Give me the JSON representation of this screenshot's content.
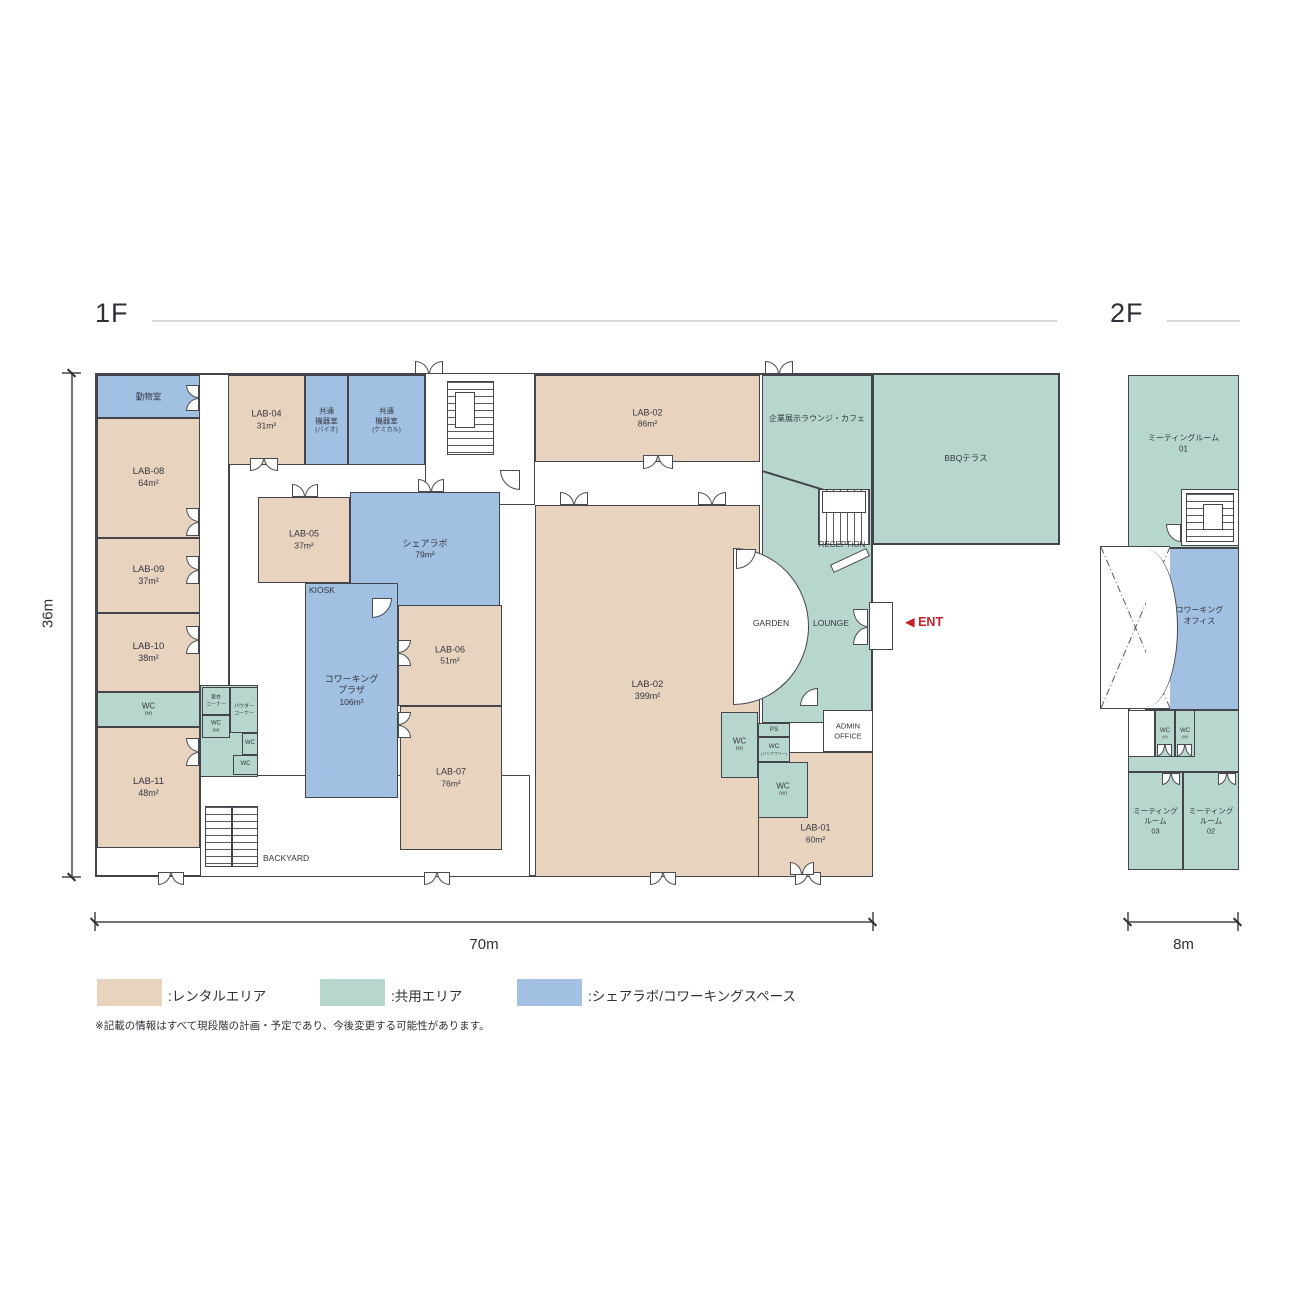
{
  "titles": {
    "floor1": "1F",
    "floor2": "2F"
  },
  "dimensions": {
    "height_1f": "36m",
    "width_1f": "70m",
    "width_2f": "8m"
  },
  "colors": {
    "wall": "#44454c",
    "rental": "#e8d4be",
    "shared": "#b7d7ce",
    "cowork": "#a2c0e1",
    "accent_red": "#c5202e",
    "header_line": "#d9d9d9"
  },
  "legend": {
    "items": [
      {
        "key": "rental",
        "label": ":レンタルエリア",
        "color": "#e8d4be"
      },
      {
        "key": "shared",
        "label": ":共用エリア",
        "color": "#b7d7ce"
      },
      {
        "key": "cowork",
        "label": ":シェアラボ/コワーキングスペース",
        "color": "#a2c0e1"
      }
    ],
    "note": "※記載の情報はすべて現段階の計画・予定であり、今後変更する可能性があります。"
  },
  "plan": {
    "boxes": [
      {
        "n": "building-1f",
        "cls": "shell",
        "x": 95,
        "y": 373,
        "w": 778,
        "h": 504
      },
      {
        "n": "bbq-terrace",
        "cls": "shared b2",
        "x": 872,
        "y": 373,
        "w": 188,
        "h": 172
      },
      {
        "n": "building-2f",
        "cls": "shell",
        "x": 1128,
        "y": 375,
        "w": 111,
        "h": 495
      },
      {
        "n": "stair-lobby",
        "cls": "wbox",
        "x": 425,
        "y": 373,
        "w": 110,
        "h": 132
      },
      {
        "n": "backyard-area",
        "cls": "wbox",
        "x": 200,
        "y": 775,
        "w": 330,
        "h": 102
      },
      {
        "n": "corridor-wall",
        "cls": "wall",
        "x": 228,
        "y": 463,
        "w": 2,
        "h": 224
      },
      {
        "n": "animal-room",
        "cls": "cowork",
        "x": 97,
        "y": 375,
        "w": 103,
        "h": 43,
        "lines": [
          [
            "動物室",
            1
          ]
        ],
        "fs": 8.5
      },
      {
        "n": "lab-08",
        "cls": "rental",
        "x": 97,
        "y": 418,
        "w": 103,
        "h": 120,
        "lines": [
          [
            "LAB-08",
            1
          ],
          [
            "64m²",
            0.95
          ]
        ],
        "fs": 9.5
      },
      {
        "n": "lab-09",
        "cls": "rental",
        "x": 97,
        "y": 538,
        "w": 103,
        "h": 75,
        "lines": [
          [
            "LAB-09",
            1
          ],
          [
            "37m²",
            0.95
          ]
        ],
        "fs": 9.5
      },
      {
        "n": "lab-10",
        "cls": "rental",
        "x": 97,
        "y": 613,
        "w": 103,
        "h": 79,
        "lines": [
          [
            "LAB-10",
            1
          ],
          [
            "38m²",
            0.95
          ]
        ],
        "fs": 9.5
      },
      {
        "n": "wc-m-west",
        "cls": "shared",
        "x": 97,
        "y": 692,
        "w": 103,
        "h": 35,
        "lines": [
          [
            "WC",
            1
          ],
          [
            "(M)",
            0.62
          ]
        ],
        "fs": 8
      },
      {
        "n": "lab-11",
        "cls": "rental",
        "x": 97,
        "y": 727,
        "w": 103,
        "h": 121,
        "lines": [
          [
            "LAB-11",
            1
          ],
          [
            "48m²",
            0.95
          ]
        ],
        "fs": 9.5
      },
      {
        "n": "lab-04",
        "cls": "rental",
        "x": 228,
        "y": 375,
        "w": 77,
        "h": 90,
        "lines": [
          [
            "LAB-04",
            1
          ],
          [
            "31m²",
            0.95
          ]
        ],
        "fs": 9
      },
      {
        "n": "equip-room-bio",
        "cls": "cowork",
        "x": 305,
        "y": 375,
        "w": 43,
        "h": 90,
        "lines": [
          [
            "共通",
            1
          ],
          [
            "機器室",
            1
          ],
          [
            "(バイオ)",
            0.82
          ]
        ],
        "fs": 7.5
      },
      {
        "n": "equip-room-chemical",
        "cls": "cowork",
        "x": 348,
        "y": 375,
        "w": 77,
        "h": 90,
        "lines": [
          [
            "共通",
            1
          ],
          [
            "機器室",
            1
          ],
          [
            "(ケミカル)",
            0.82
          ]
        ],
        "fs": 7.5
      },
      {
        "n": "lab-02-north",
        "cls": "rental",
        "x": 535,
        "y": 375,
        "w": 225,
        "h": 87,
        "lines": [
          [
            "LAB-02",
            1
          ],
          [
            "86m²",
            0.95
          ]
        ],
        "fs": 9
      },
      {
        "n": "lounge-area",
        "cls": "shared",
        "x": 762,
        "y": 375,
        "w": 110,
        "h": 348
      },
      {
        "n": "lab-05",
        "cls": "rental",
        "x": 258,
        "y": 497,
        "w": 92,
        "h": 86,
        "lines": [
          [
            "LAB-05",
            1
          ],
          [
            "37m²",
            0.95
          ]
        ],
        "fs": 9
      },
      {
        "n": "share-lab",
        "cls": "cowork",
        "x": 350,
        "y": 492,
        "w": 150,
        "h": 115,
        "lines": [
          [
            "シェアラボ",
            1
          ],
          [
            "79m²",
            0.95
          ]
        ],
        "fs": 9
      },
      {
        "n": "cowork-plaza",
        "cls": "cowork",
        "x": 305,
        "y": 583,
        "w": 93,
        "h": 215,
        "lines": [
          [
            "コワーキング",
            1
          ],
          [
            "プラザ",
            1
          ],
          [
            "106m²",
            0.95
          ]
        ],
        "fs": 9
      },
      {
        "n": "lab-06",
        "cls": "rental",
        "x": 398,
        "y": 605,
        "w": 104,
        "h": 101,
        "lines": [
          [
            "LAB-06",
            1
          ],
          [
            "51m²",
            0.95
          ]
        ],
        "fs": 9
      },
      {
        "n": "lab-07",
        "cls": "rental",
        "x": 400,
        "y": 706,
        "w": 102,
        "h": 144,
        "lines": [
          [
            "LAB-07",
            1
          ],
          [
            "76m²",
            0.95
          ]
        ],
        "fs": 9
      },
      {
        "n": "lab-02-main",
        "cls": "rental",
        "x": 535,
        "y": 505,
        "w": 225,
        "h": 372,
        "lines": [
          [
            "LAB-02",
            1
          ],
          [
            "399m²",
            0.95
          ]
        ],
        "fs": 9.5
      },
      {
        "n": "service-block",
        "cls": "shared",
        "x": 200,
        "y": 685,
        "w": 58,
        "h": 92
      },
      {
        "n": "changing-corner",
        "cls": "shared",
        "x": 202,
        "y": 687,
        "w": 28,
        "h": 28,
        "lines": [
          [
            "更衣",
            1
          ],
          [
            "コーナー",
            1
          ]
        ],
        "fs": 5
      },
      {
        "n": "powder-corner",
        "cls": "shared",
        "x": 230,
        "y": 687,
        "w": 28,
        "h": 46,
        "lines": [
          [
            "パウダー",
            1
          ],
          [
            "コーナー",
            1
          ]
        ],
        "fs": 5
      },
      {
        "n": "wc-w-mid",
        "cls": "shared",
        "x": 202,
        "y": 715,
        "w": 28,
        "h": 23,
        "lines": [
          [
            "WC",
            1
          ],
          [
            "(W)",
            0.7
          ]
        ],
        "fs": 6
      },
      {
        "n": "wc-mid-1",
        "cls": "shared",
        "x": 242,
        "y": 733,
        "w": 16,
        "h": 22,
        "lines": [
          [
            "WC",
            1
          ]
        ],
        "fs": 6
      },
      {
        "n": "wc-mid-2",
        "cls": "shared",
        "x": 233,
        "y": 755,
        "w": 25,
        "h": 20,
        "lines": [
          [
            "WC",
            1
          ]
        ],
        "fs": 6
      },
      {
        "n": "wc-m-east",
        "cls": "shared",
        "x": 721,
        "y": 712,
        "w": 37,
        "h": 66,
        "lines": [
          [
            "WC",
            1
          ],
          [
            "(M)",
            0.62
          ]
        ],
        "fs": 8
      },
      {
        "n": "lab-01",
        "cls": "rental",
        "x": 758,
        "y": 752,
        "w": 115,
        "h": 125,
        "lines": [
          [
            "LAB-01",
            1
          ],
          [
            "60m²",
            0.95
          ]
        ],
        "fs": 9,
        "ly": 66
      },
      {
        "n": "ps",
        "cls": "shared",
        "x": 758,
        "y": 723,
        "w": 32,
        "h": 14,
        "lines": [
          [
            "PS",
            1
          ]
        ],
        "fs": 6.5
      },
      {
        "n": "wc-barrier-free",
        "cls": "shared",
        "x": 758,
        "y": 737,
        "w": 32,
        "h": 25,
        "lines": [
          [
            "WC",
            1
          ],
          [
            "(バリアフリー)",
            0.6
          ]
        ],
        "fs": 6.5
      },
      {
        "n": "wc-w-east",
        "cls": "shared",
        "x": 758,
        "y": 762,
        "w": 50,
        "h": 56,
        "lines": [
          [
            "WC",
            1
          ],
          [
            "(W)",
            0.62
          ]
        ],
        "fs": 8
      },
      {
        "n": "admin-office",
        "cls": "white",
        "x": 823,
        "y": 710,
        "w": 50,
        "h": 42,
        "lines": [
          [
            "ADMIN",
            1
          ],
          [
            "OFFICE",
            1
          ]
        ],
        "fs": 7.5
      },
      {
        "n": "garden-court",
        "cls": "garden",
        "x": 733,
        "y": 548,
        "w": 76,
        "h": 157
      },
      {
        "n": "wall-diagonal",
        "cls": "diag",
        "x": 762,
        "y": 470,
        "w": 72,
        "h": 2
      },
      {
        "n": "stairs-main",
        "cls": "stairs sv",
        "x": 447,
        "y": 381,
        "w": 47,
        "h": 74
      },
      {
        "n": "stairs-main-core",
        "cls": "wcore",
        "x": 455,
        "y": 392,
        "w": 20,
        "h": 36
      },
      {
        "n": "stairs-reception",
        "cls": "stairs sh",
        "x": 818,
        "y": 489,
        "w": 52,
        "h": 56
      },
      {
        "n": "stairs-reception-core",
        "cls": "wcore",
        "x": 822,
        "y": 491,
        "w": 44,
        "h": 22
      },
      {
        "n": "reception-desk",
        "cls": "desk",
        "x": 830,
        "y": 556,
        "w": 40,
        "h": 9
      },
      {
        "n": "entrance-vestibule",
        "cls": "wbox",
        "x": 869,
        "y": 602,
        "w": 24,
        "h": 48
      },
      {
        "n": "stairs-backyard",
        "cls": "stairs sv",
        "x": 205,
        "y": 806,
        "w": 53,
        "h": 61
      },
      {
        "n": "stairs-backyard-rail",
        "cls": "wall",
        "x": 231,
        "y": 806,
        "w": 2,
        "h": 61
      },
      {
        "n": "mtg-room-01",
        "cls": "shared",
        "x": 1128,
        "y": 375,
        "w": 111,
        "h": 173,
        "lines": [
          [
            "ミーティングルーム",
            1
          ],
          [
            "01",
            1
          ]
        ],
        "fs": 8,
        "ly": 40
      },
      {
        "n": "cowork-office",
        "cls": "cowork",
        "x": 1145,
        "y": 548,
        "w": 94,
        "h": 162,
        "lines": [
          [
            "コワーキング",
            1
          ],
          [
            "オフィス",
            1
          ]
        ],
        "fs": 8,
        "lx": 58,
        "ly": 42
      },
      {
        "n": "void-open-below",
        "cls": "xbox",
        "x": 1100,
        "y": 546,
        "w": 70,
        "h": 163
      },
      {
        "n": "void-curve",
        "cls": "curve",
        "x": 1146,
        "y": 549,
        "w": 32,
        "h": 158
      },
      {
        "n": "corridor-2f",
        "cls": "shared",
        "x": 1128,
        "y": 710,
        "w": 111,
        "h": 62
      },
      {
        "n": "corridor-2f-west",
        "cls": "wbox",
        "x": 1128,
        "y": 710,
        "w": 27,
        "h": 47
      },
      {
        "n": "wc-m-2f",
        "cls": "shared",
        "x": 1155,
        "y": 710,
        "w": 20,
        "h": 47,
        "lines": [
          [
            "WC",
            1
          ],
          [
            "(M)",
            0.6
          ]
        ],
        "fs": 6
      },
      {
        "n": "wc-w-2f",
        "cls": "shared",
        "x": 1175,
        "y": 710,
        "w": 20,
        "h": 47,
        "lines": [
          [
            "WC",
            1
          ],
          [
            "(W)",
            0.6
          ]
        ],
        "fs": 6
      },
      {
        "n": "mtg-room-03",
        "cls": "shared",
        "x": 1128,
        "y": 772,
        "w": 55,
        "h": 98,
        "lines": [
          [
            "ミーティング",
            1
          ],
          [
            "ルーム",
            1
          ],
          [
            "03",
            1
          ]
        ],
        "fs": 7.5
      },
      {
        "n": "mtg-room-02",
        "cls": "shared",
        "x": 1183,
        "y": 772,
        "w": 56,
        "h": 98,
        "lines": [
          [
            "ミーティング",
            1
          ],
          [
            "ルーム",
            1
          ],
          [
            "02",
            1
          ]
        ],
        "fs": 7.5
      },
      {
        "n": "stairs-2f-box",
        "cls": "wbox",
        "x": 1181,
        "y": 489,
        "w": 58,
        "h": 57
      },
      {
        "n": "stairs-2f",
        "cls": "stairs sv",
        "x": 1186,
        "y": 493,
        "w": 48,
        "h": 49
      },
      {
        "n": "stairs-2f-core",
        "cls": "wcore",
        "x": 1203,
        "y": 504,
        "w": 20,
        "h": 26
      }
    ],
    "doors": [
      {
        "x": 186,
        "y": 385,
        "w": 13,
        "h": 26,
        "t": "left"
      },
      {
        "x": 186,
        "y": 508,
        "w": 13,
        "h": 28,
        "t": "left"
      },
      {
        "x": 186,
        "y": 556,
        "w": 13,
        "h": 28,
        "t": "left"
      },
      {
        "x": 186,
        "y": 626,
        "w": 13,
        "h": 28,
        "t": "left"
      },
      {
        "x": 186,
        "y": 738,
        "w": 13,
        "h": 28,
        "t": "left"
      },
      {
        "x": 250,
        "y": 458,
        "w": 28,
        "h": 13,
        "t": "down"
      },
      {
        "x": 415,
        "y": 361,
        "w": 28,
        "h": 13,
        "t": "up"
      },
      {
        "x": 765,
        "y": 361,
        "w": 28,
        "h": 13,
        "t": "up"
      },
      {
        "x": 643,
        "y": 455,
        "w": 30,
        "h": 14,
        "t": "down"
      },
      {
        "x": 560,
        "y": 492,
        "w": 28,
        "h": 13,
        "t": "up"
      },
      {
        "x": 698,
        "y": 492,
        "w": 28,
        "h": 13,
        "t": "up"
      },
      {
        "x": 292,
        "y": 484,
        "w": 26,
        "h": 13,
        "t": "up"
      },
      {
        "x": 418,
        "y": 479,
        "w": 26,
        "h": 13,
        "t": "up"
      },
      {
        "x": 398,
        "y": 640,
        "w": 13,
        "h": 26,
        "t": "right"
      },
      {
        "x": 398,
        "y": 712,
        "w": 13,
        "h": 26,
        "t": "right"
      },
      {
        "x": 372,
        "y": 598,
        "w": 20,
        "h": 20,
        "t": "q-br"
      },
      {
        "x": 736,
        "y": 549,
        "w": 20,
        "h": 20,
        "t": "q-br"
      },
      {
        "x": 500,
        "y": 470,
        "w": 20,
        "h": 20,
        "t": "q-bl"
      },
      {
        "x": 800,
        "y": 688,
        "w": 18,
        "h": 18,
        "t": "q-tl"
      },
      {
        "x": 158,
        "y": 872,
        "w": 26,
        "h": 13,
        "t": "down"
      },
      {
        "x": 424,
        "y": 872,
        "w": 26,
        "h": 13,
        "t": "down"
      },
      {
        "x": 650,
        "y": 872,
        "w": 26,
        "h": 13,
        "t": "down"
      },
      {
        "x": 795,
        "y": 872,
        "w": 26,
        "h": 13,
        "t": "down"
      },
      {
        "x": 853,
        "y": 609,
        "w": 15,
        "h": 36,
        "t": "left"
      },
      {
        "x": 790,
        "y": 862,
        "w": 24,
        "h": 13,
        "t": "up"
      },
      {
        "x": 1157,
        "y": 744,
        "w": 15,
        "h": 12,
        "t": "down"
      },
      {
        "x": 1177,
        "y": 744,
        "w": 15,
        "h": 12,
        "t": "down"
      },
      {
        "x": 1166,
        "y": 524,
        "w": 15,
        "h": 18,
        "t": "q-bl"
      },
      {
        "x": 1162,
        "y": 773,
        "w": 18,
        "h": 12,
        "t": "down"
      },
      {
        "x": 1218,
        "y": 773,
        "w": 18,
        "h": 12,
        "t": "down"
      }
    ],
    "texts": [
      {
        "n": "label-kiosk",
        "x": 309,
        "y": 585,
        "w": 60,
        "t": "KIOSK",
        "fs": 8.5,
        "al": "left"
      },
      {
        "n": "label-exhibit-lounge-cafe",
        "x": 762,
        "y": 413,
        "w": 110,
        "t": "企業展示ラウンジ・カフェ",
        "fs": 8,
        "al": "center"
      },
      {
        "n": "label-bbq-terrace",
        "x": 872,
        "y": 452,
        "w": 188,
        "t": "BBQテラス",
        "fs": 8.5,
        "al": "center"
      },
      {
        "n": "label-reception",
        "x": 808,
        "y": 540,
        "w": 68,
        "t": "RECEPTION",
        "fs": 8,
        "al": "center"
      },
      {
        "n": "label-garden",
        "x": 733,
        "y": 618,
        "w": 76,
        "t": "GARDEN",
        "fs": 8.5,
        "al": "center"
      },
      {
        "n": "label-lounge",
        "x": 799,
        "y": 618,
        "w": 64,
        "t": "LOUNGE",
        "fs": 8.5,
        "al": "center"
      },
      {
        "n": "label-backyard",
        "x": 263,
        "y": 853,
        "w": 100,
        "t": "BACKYARD",
        "fs": 8.5,
        "al": "left"
      },
      {
        "n": "label-entrance",
        "x": 905,
        "y": 614,
        "w": 90,
        "t": "◀ ENT",
        "fs": 12.5,
        "al": "left",
        "c": "#c5202e",
        "b": true
      }
    ]
  }
}
